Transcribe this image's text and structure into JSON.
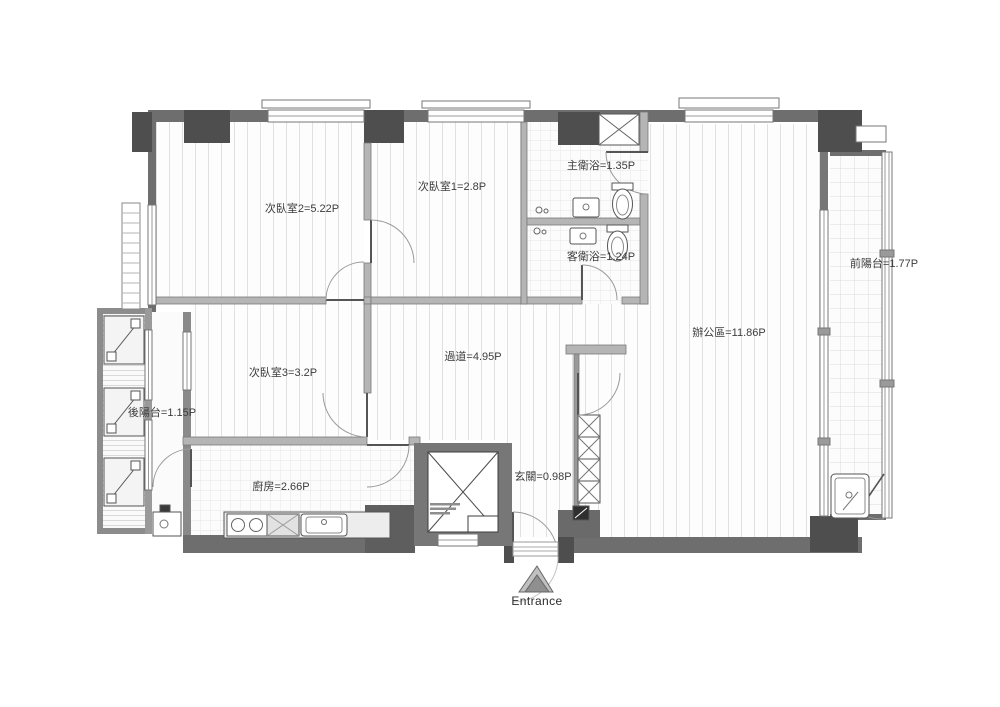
{
  "plan_title": "apartment-floor-plan",
  "rooms": {
    "bedroom2": {
      "label": "次臥室2=5.22P"
    },
    "bedroom1": {
      "label": "次臥室1=2.8P"
    },
    "master_bath": {
      "label": "主衛浴=1.35P"
    },
    "guest_bath": {
      "label": "客衛浴=1.24P"
    },
    "office": {
      "label": "辦公區=11.86P"
    },
    "front_balcony": {
      "label": "前陽台=1.77P"
    },
    "bedroom3": {
      "label": "次臥室3=3.2P"
    },
    "corridor": {
      "label": "過道=4.95P"
    },
    "rear_balcony": {
      "label": "後陽台=1.15P"
    },
    "kitchen": {
      "label": "廚房=2.66P"
    },
    "foyer": {
      "label": "玄關=0.98P"
    }
  },
  "entrance": {
    "label": "Entrance"
  },
  "colors": {
    "exterior_wall": "#6e6e6e",
    "column": "#4e4e4e",
    "interior_wall": "#b5b5b5",
    "floor_line": "#dedede",
    "label_text": "#3d3d3d"
  }
}
